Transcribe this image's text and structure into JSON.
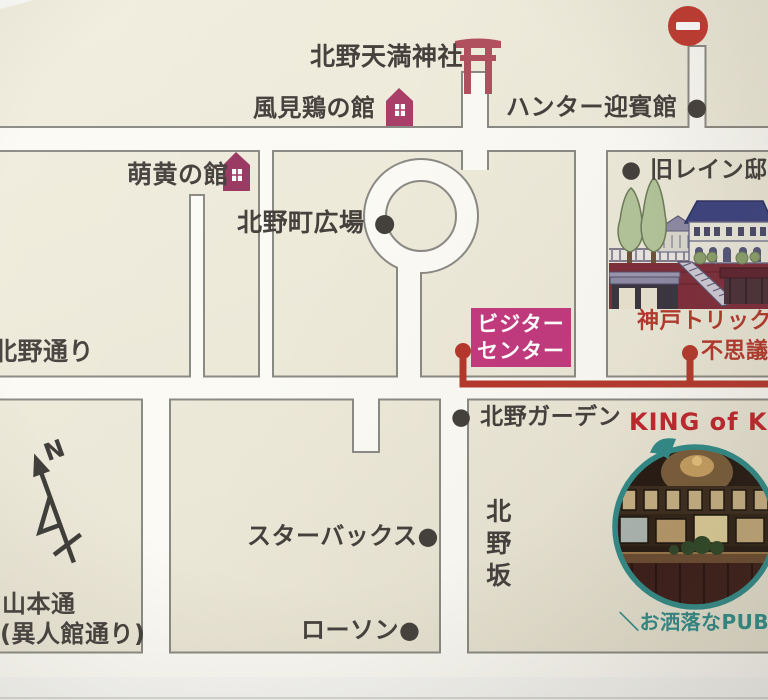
{
  "map_title": "北野エリア案内図",
  "labels": {
    "shrine": "北野天満神社",
    "weathercock_house": "風見鶏の館",
    "hunter_house": "ハンター迎賓館 ●",
    "moegi_house": "萌黄の館",
    "kitano_plaza": "北野町広場 ●",
    "former_rhine_house": "● 旧レイン邸",
    "visitor_center_line1": "ビジター",
    "visitor_center_line2": "センター",
    "trick_art_line1": "神戸トリック",
    "trick_art_line2": "不思議",
    "kitano_street": "北野通り",
    "kitano_garden": "● 北野ガーデン",
    "king_of_kings": "KING of KING",
    "starbucks": "スターバックス●",
    "kitanozaka": "北野坂",
    "lawson": "ローソン●",
    "yamamoto_street_line1": "山本通",
    "yamamoto_street_line2": "(異人館通り)",
    "pub_caption": "＼お洒落なPUB／",
    "compass_north": "N"
  },
  "icons": {
    "torii": "torii-gate-icon",
    "house_weathercock": "house-icon",
    "house_moegi": "house-icon",
    "no_entry": "no-entry-sign-icon",
    "compass": "north-arrow-icon",
    "route_marker": "●",
    "pub_photo": "circular-pub-interior-photo",
    "illustration": "trick-art-museum-building-drawing"
  },
  "colors": {
    "block_cream": "#eeebdc",
    "road_white": "#fbfaf4",
    "road_border": "#8b8983",
    "visitor_center_magenta": "#c23a7e",
    "route_red": "#b5382c",
    "king_red": "#c0262c",
    "photo_ring_teal": "#2f8b89",
    "landmark_maroon": "#a23a64",
    "text_dark": "#44403c"
  }
}
